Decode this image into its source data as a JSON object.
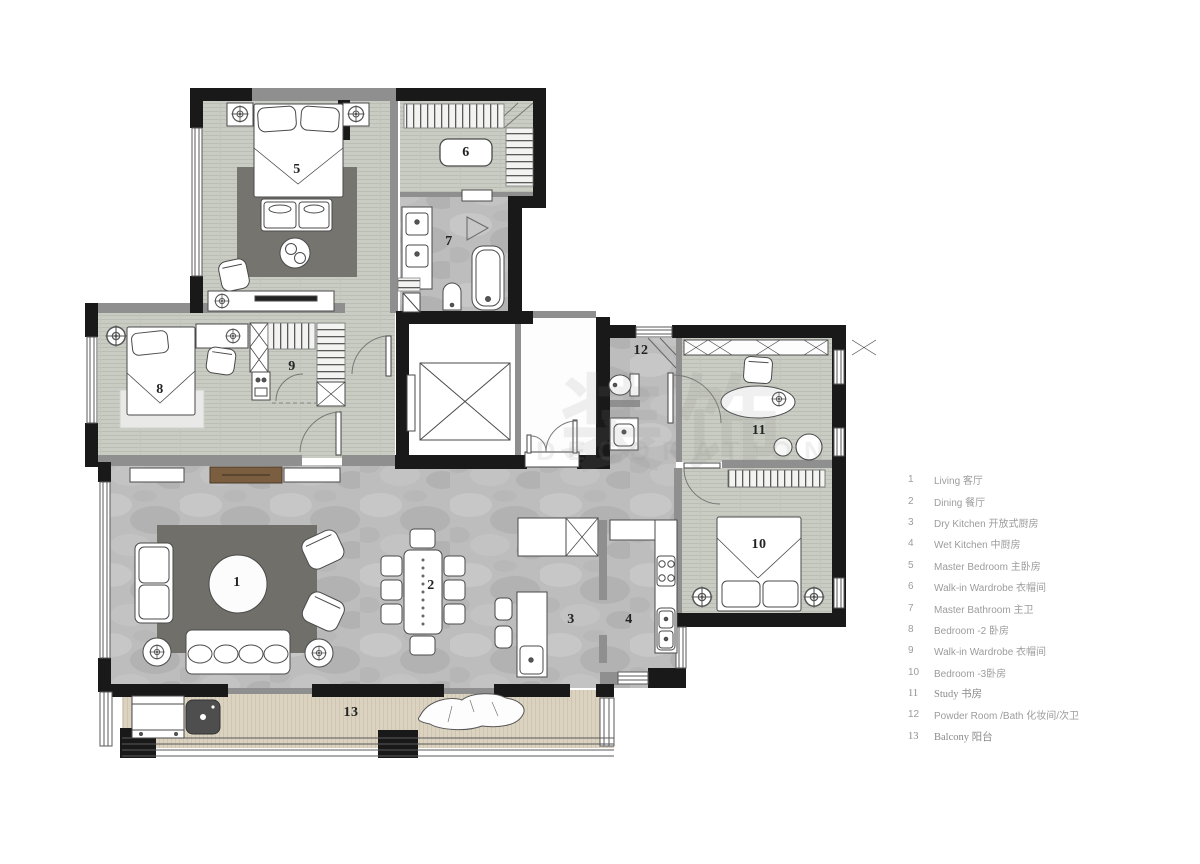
{
  "document": {
    "kind": "apartment floor plan"
  },
  "colors": {
    "exterior_wall": "#191919",
    "interior_wall": "#8f8f8f",
    "wood_floor": "#c9ccc3",
    "marble_floor": "#bdbdbd",
    "balcony_floor": "#dbd3c0",
    "rug_dark": "#75746e",
    "legend_text": "#9c9c9c"
  },
  "watermark": {
    "cn": "装饰",
    "en": "DECORATION"
  },
  "plan": {
    "rooms": [
      {
        "number": "1",
        "name": "Living 客厅"
      },
      {
        "number": "2",
        "name": "Dining 餐厅"
      },
      {
        "number": "3",
        "name": "Dry Kitchen 开放式厨房"
      },
      {
        "number": "4",
        "name": "Wet Kitchen 中厨房"
      },
      {
        "number": "5",
        "name": "Master Bedroom 主卧房"
      },
      {
        "number": "6",
        "name": "Walk-in Wardrobe 衣帽间"
      },
      {
        "number": "7",
        "name": "Master Bathroom 主卫"
      },
      {
        "number": "8",
        "name": "Bedroom -2 卧房"
      },
      {
        "number": "9",
        "name": "Walk-in Wardrobe 衣帽间"
      },
      {
        "number": "10",
        "name": "Bedroom -3卧房"
      },
      {
        "number": "11",
        "name": "Study 书房"
      },
      {
        "number": "12",
        "name": "Powder Room /Bath 化妆间/次卫"
      },
      {
        "number": "13",
        "name": "Balcony 阳台"
      }
    ]
  },
  "legend": {
    "items": [
      {
        "num": "1",
        "label": "Living 客厅"
      },
      {
        "num": "2",
        "label": "Dining 餐厅"
      },
      {
        "num": "3",
        "label": "Dry Kitchen 开放式厨房"
      },
      {
        "num": "4",
        "label": "Wet Kitchen 中厨房"
      },
      {
        "num": "5",
        "label": "Master Bedroom 主卧房"
      },
      {
        "num": "6",
        "label": "Walk-in Wardrobe 衣帽间"
      },
      {
        "num": "7",
        "label": "Master Bathroom 主卫"
      },
      {
        "num": "8",
        "label": "Bedroom -2 卧房"
      },
      {
        "num": "9",
        "label": "Walk-in Wardrobe 衣帽间"
      },
      {
        "num": "10",
        "label": "Bedroom -3卧房"
      },
      {
        "num": "11",
        "label": "Study 书房"
      },
      {
        "num": "12",
        "label": "Powder Room /Bath 化妆间/次卫"
      },
      {
        "num": "13",
        "label": "Balcony 阳台"
      }
    ]
  }
}
